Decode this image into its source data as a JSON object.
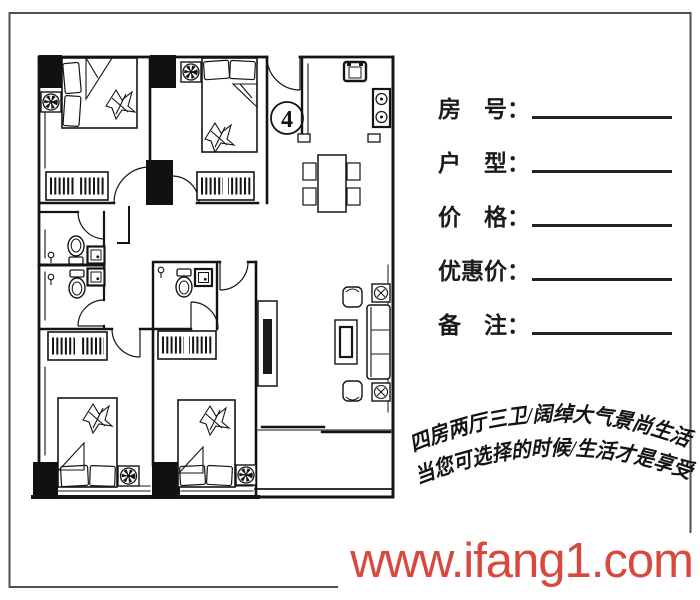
{
  "plan": {
    "unit_number": "4",
    "description": "floor plan of a 4-bedroom, 2-hall, 3-bath apartment"
  },
  "form": {
    "fields": [
      {
        "name": "room-number",
        "label": "房　号：",
        "value": ""
      },
      {
        "name": "unit-type",
        "label": "户　型：",
        "value": ""
      },
      {
        "name": "price",
        "label": "价　格：",
        "value": ""
      },
      {
        "name": "discount-price",
        "label": "优惠价：",
        "value": ""
      },
      {
        "name": "notes",
        "label": "备　注：",
        "value": ""
      }
    ]
  },
  "slogan": {
    "line1": "四房两厅三卫/阔绰大气景尚生活",
    "line2": "当您可选择的时候/生活才是享受"
  },
  "watermark": {
    "text": "www.ifang1.com",
    "color": "#d9483e"
  },
  "colors": {
    "ink": "#141414",
    "frame": "#4f4f4f",
    "background": "#ffffff"
  }
}
